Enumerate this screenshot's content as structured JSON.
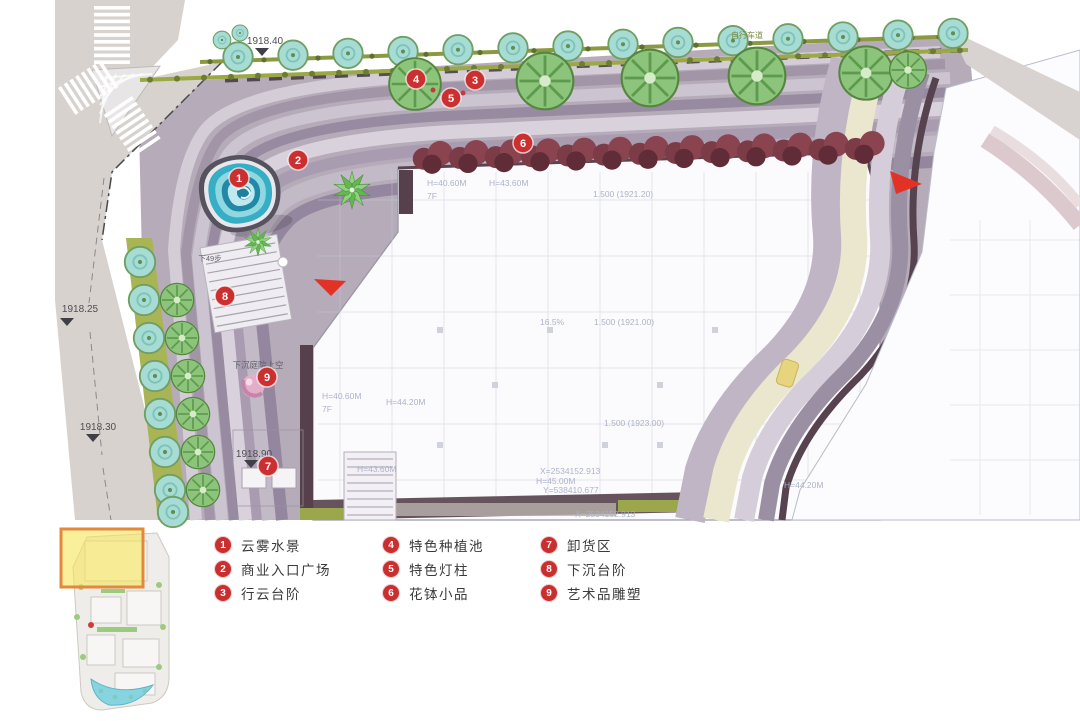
{
  "legend": {
    "items": [
      {
        "num": "1",
        "label": "云雾水景"
      },
      {
        "num": "2",
        "label": "商业入口广场"
      },
      {
        "num": "3",
        "label": "行云台阶"
      },
      {
        "num": "4",
        "label": "特色种植池"
      },
      {
        "num": "5",
        "label": "特色灯柱"
      },
      {
        "num": "6",
        "label": "花钵小品"
      },
      {
        "num": "7",
        "label": "卸货区"
      },
      {
        "num": "8",
        "label": "下沉台阶"
      },
      {
        "num": "9",
        "label": "艺术品雕塑"
      }
    ]
  },
  "plan": {
    "markers": [
      {
        "num": "1",
        "x": 239,
        "y": 178
      },
      {
        "num": "2",
        "x": 298,
        "y": 160
      },
      {
        "num": "3",
        "x": 475,
        "y": 80
      },
      {
        "num": "4",
        "x": 416,
        "y": 79
      },
      {
        "num": "5",
        "x": 451,
        "y": 98
      },
      {
        "num": "6",
        "x": 523,
        "y": 143
      },
      {
        "num": "7",
        "x": 268,
        "y": 466
      },
      {
        "num": "8",
        "x": 225,
        "y": 296
      },
      {
        "num": "9",
        "x": 267,
        "y": 377
      }
    ],
    "elevation_labels": [
      {
        "text": "1918.40",
        "x": 265,
        "y": 44,
        "tx": 262,
        "ty": 48
      },
      {
        "text": "1918.25",
        "x": 80,
        "y": 312,
        "tx": 67,
        "ty": 318
      },
      {
        "text": "1918.30",
        "x": 98,
        "y": 430,
        "tx": 93,
        "ty": 434
      },
      {
        "text": "1918.90",
        "x": 254,
        "y": 457,
        "tx": 251,
        "ty": 460
      }
    ],
    "area_labels": [
      {
        "text": "自行车道",
        "x": 747,
        "y": 38,
        "size": 8,
        "color": "#7a8a42"
      },
      {
        "text": "下49步",
        "x": 210,
        "y": 261,
        "size": 7.5,
        "color": "#63636a"
      },
      {
        "text": "下沉庭院上空",
        "x": 258,
        "y": 368,
        "size": 8.5,
        "color": "#63636a"
      }
    ],
    "building_labels": [
      {
        "text": "H=40.60M",
        "x": 427,
        "y": 186
      },
      {
        "text": "7F",
        "x": 427,
        "y": 199
      },
      {
        "text": "H=43.60M",
        "x": 489,
        "y": 186
      },
      {
        "text": "1.500 (1921.20)",
        "x": 593,
        "y": 197
      },
      {
        "text": "16.5%",
        "x": 540,
        "y": 325
      },
      {
        "text": "1.500 (1921.00)",
        "x": 594,
        "y": 325
      },
      {
        "text": "1.500 (1923.00)",
        "x": 604,
        "y": 426
      },
      {
        "text": "H=40.60M",
        "x": 322,
        "y": 399
      },
      {
        "text": "7F",
        "x": 322,
        "y": 412
      },
      {
        "text": "H=44.20M",
        "x": 386,
        "y": 405
      },
      {
        "text": "H=43.60M",
        "x": 357,
        "y": 472
      },
      {
        "text": "X=2534152.913",
        "x": 540,
        "y": 474
      },
      {
        "text": "H=45.00M",
        "x": 536,
        "y": 484
      },
      {
        "text": "Y=538410.677",
        "x": 543,
        "y": 493
      },
      {
        "text": "X=2534152.913",
        "x": 575,
        "y": 517
      },
      {
        "text": "H=44.20M",
        "x": 784,
        "y": 488
      }
    ],
    "colors": {
      "marker_red": "#cb2f2f",
      "arrow_red": "#e23226",
      "plaza_base": "#b5abb9",
      "road_grey": "#d7d2ce",
      "tree_teal": "#a7dcd4",
      "tree_green": "#8cc47c",
      "building_white": "#fbfafc",
      "edge_maroon": "#55404b",
      "path_beige": "#ebe6ce",
      "olive_lane": "#8b9a40"
    }
  },
  "minimap": {
    "highlight_fill": "#f7e557",
    "highlight_border": "#e2893b"
  }
}
